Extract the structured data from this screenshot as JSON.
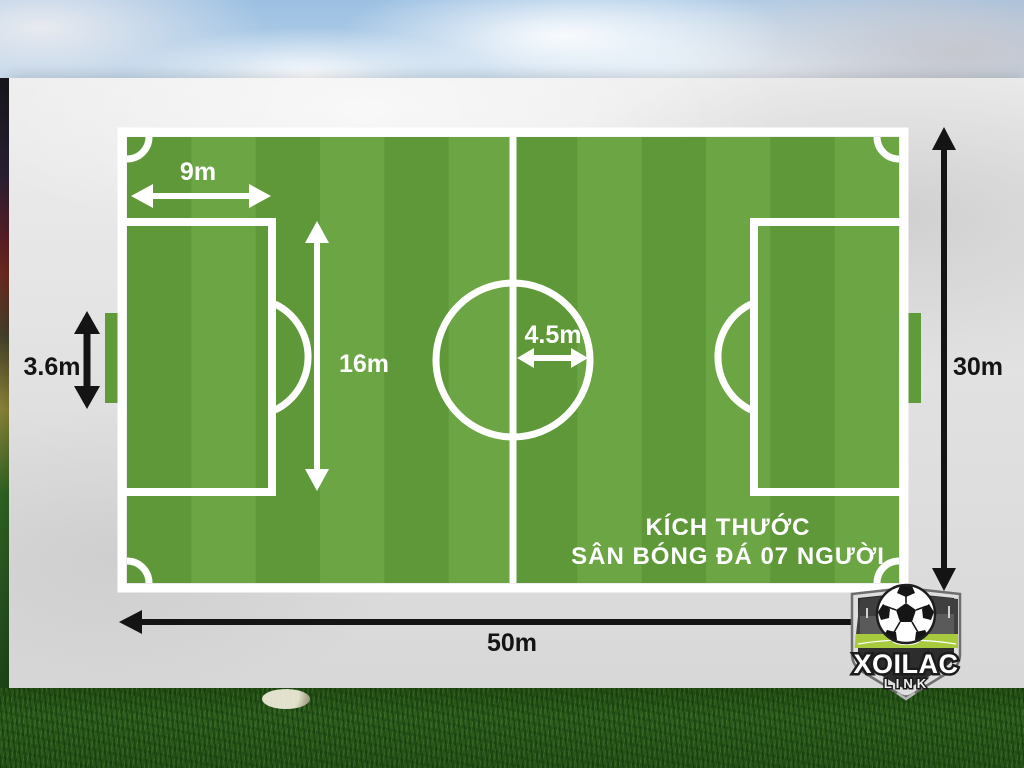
{
  "title": {
    "line1": "KÍCH THƯỚC",
    "line2": "SÂN BÓNG ĐÁ 07 NGƯỜI"
  },
  "dimensions": {
    "penalty_area_width": "9m",
    "penalty_area_length": "16m",
    "center_circle_radius": "4.5m",
    "goal_width": "3.6m",
    "pitch_width": "30m",
    "pitch_length": "50m"
  },
  "logo": {
    "brand": "XOILAC",
    "sub": "LINK"
  },
  "colors": {
    "stripe_dark": "#5f9838",
    "stripe_light": "#6ca544",
    "pitch_line": "#ffffff",
    "goal_fill": "#5f9c39",
    "label_on_pitch": "#ffffff",
    "label_outside": "#141414",
    "logo_field_lime": "#a8ca3e",
    "logo_shield_dark": "#2d2d2d",
    "logo_shield_silver": "#dedede"
  }
}
